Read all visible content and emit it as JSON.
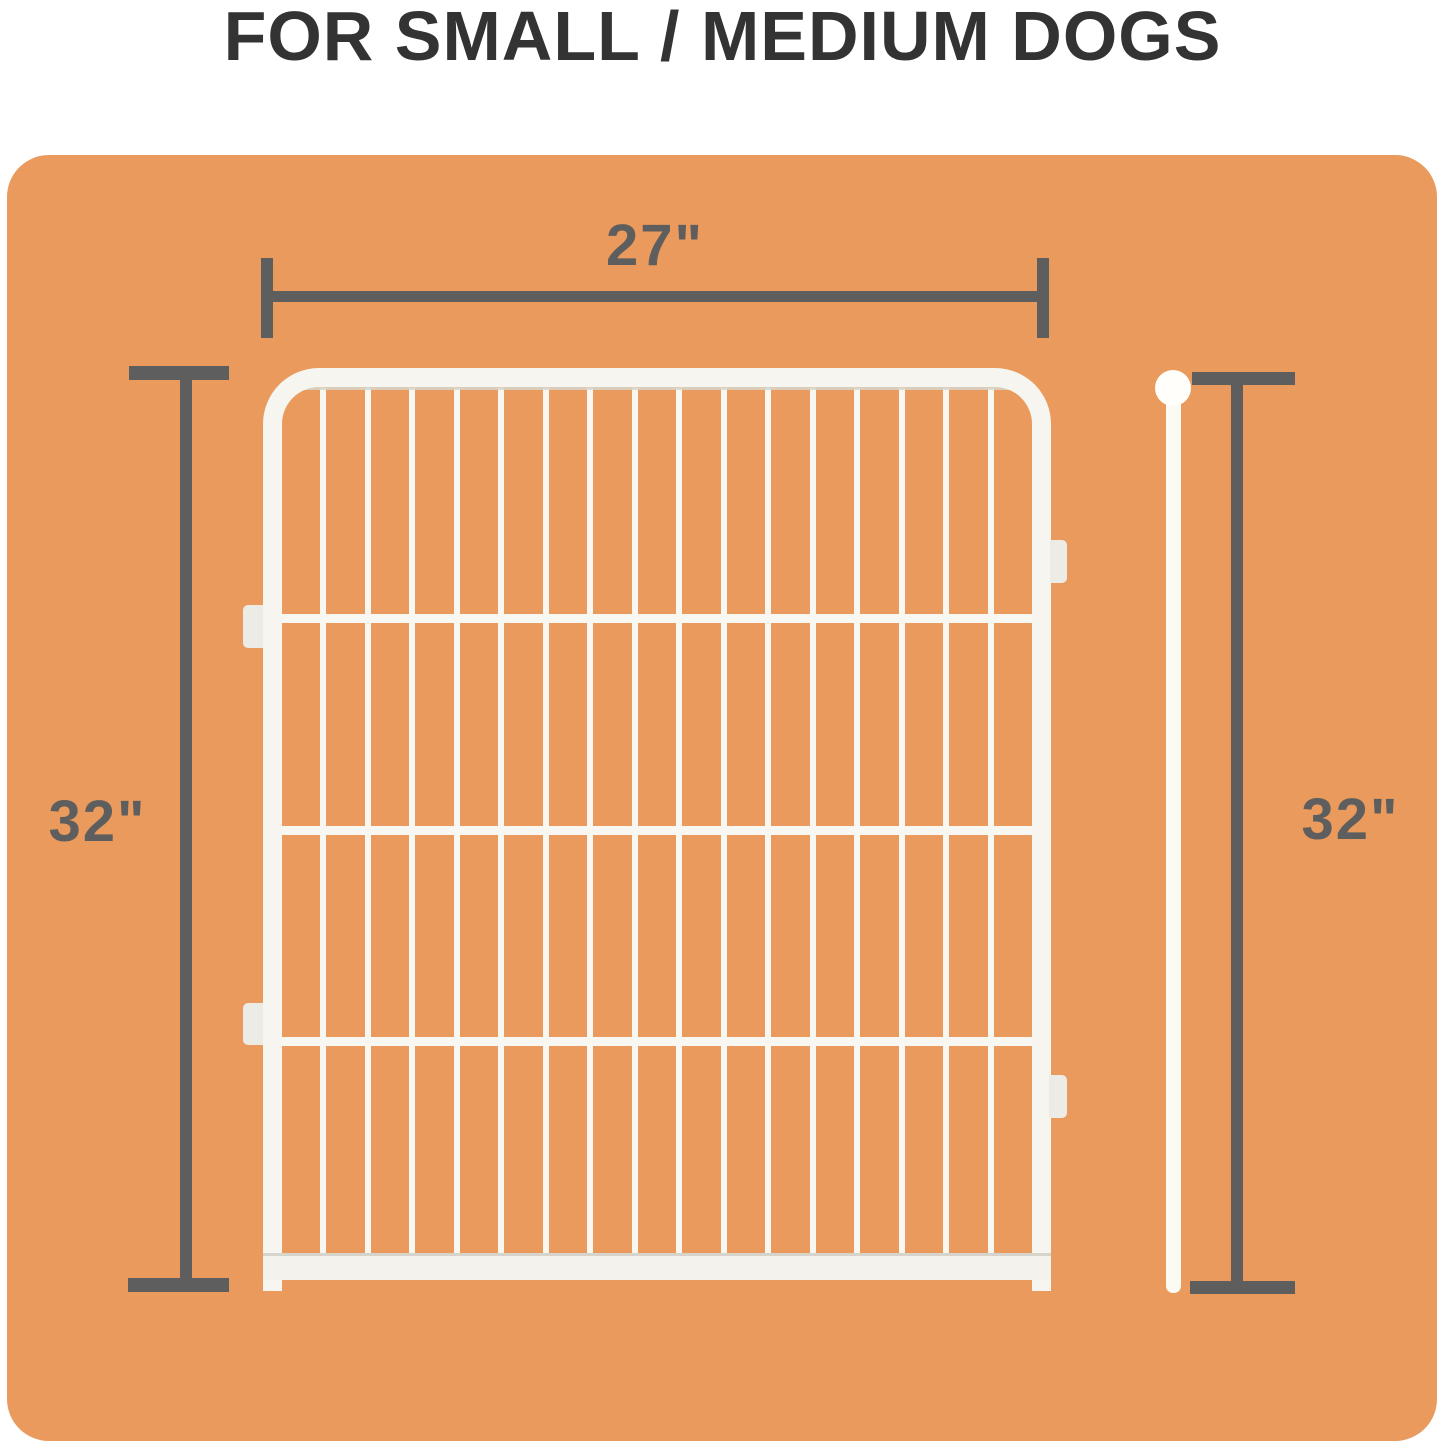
{
  "title": "FOR SMALL / MEDIUM DOGS",
  "dimensions": {
    "width": "27\"",
    "height_left": "32\"",
    "height_right": "32\""
  },
  "colors": {
    "background": "#FFFFFF",
    "panel": "#EA9A5C",
    "dimension_lines": "#5E5E5E",
    "title_text": "#333333",
    "pen_white": "#F6F5EF"
  },
  "pen_panel": {
    "vertical_wire_count": 16,
    "horizontal_wire_count": 3,
    "connector_tab_count": 4
  }
}
